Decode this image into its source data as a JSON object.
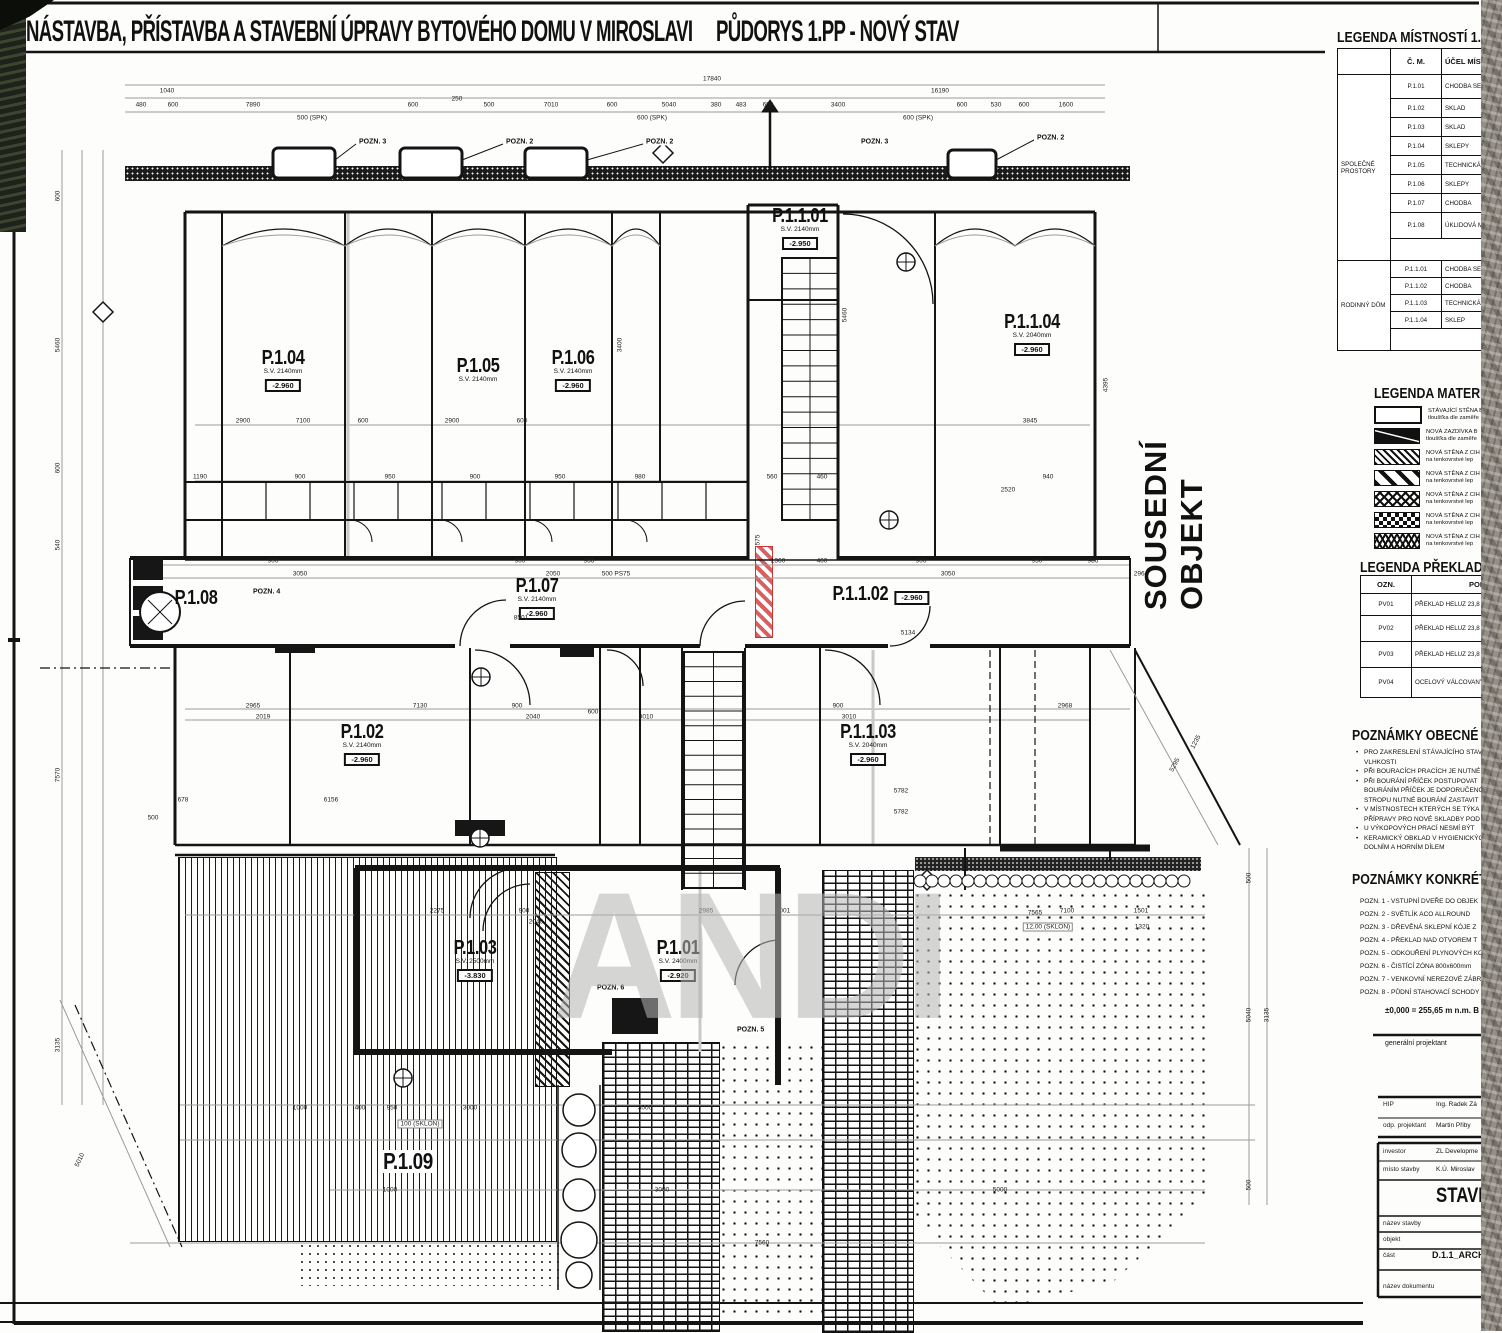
{
  "page": {
    "title_left": "NÁSTAVBA, PŘÍSTAVBA A STAVEBNÍ ÚPRAVY BYTOVÉHO DOMU V MIROSLAVI",
    "title_right": "PŮDORYS 1.PP - NOVÝ STAV"
  },
  "plan": {
    "neighbor_label": "SOUSEDNÍ OBJEKT",
    "watermark": "ANDI",
    "rooms": [
      {
        "id": "P.1.04",
        "x": 283,
        "y": 348,
        "sv": "S.V. 2140mm",
        "lvl": "-2.960"
      },
      {
        "id": "P.1.05",
        "x": 478,
        "y": 356,
        "sv": "S.V. 2140mm",
        "lvl": ""
      },
      {
        "id": "P.1.06",
        "x": 573,
        "y": 348,
        "sv": "S.V. 2140mm",
        "lvl": "-2.960"
      },
      {
        "id": "P.1.1.01",
        "x": 800,
        "y": 206,
        "sv": "S.V. 2140mm",
        "lvl": "-2.950"
      },
      {
        "id": "P.1.1.04",
        "x": 1032,
        "y": 312,
        "sv": "S.V. 2040mm",
        "lvl": "-2.960"
      },
      {
        "id": "P.1.08",
        "x": 196,
        "y": 588,
        "sv": "",
        "lvl": ""
      },
      {
        "id": "P.1.07",
        "x": 537,
        "y": 576,
        "sv": "S.V. 2140mm",
        "lvl": "-2.960"
      },
      {
        "id": "P.1.1.02",
        "x": 878,
        "y": 584,
        "sv": "",
        "lvl": "-2.960"
      },
      {
        "id": "P.1.02",
        "x": 362,
        "y": 722,
        "sv": "S.V. 2140mm",
        "lvl": "-2.960"
      },
      {
        "id": "P.1.1.03",
        "x": 868,
        "y": 722,
        "sv": "S.V. 2040mm",
        "lvl": "-2.960"
      },
      {
        "id": "P.1.03",
        "x": 475,
        "y": 938,
        "sv": "S.V. 2500mm",
        "lvl": "-3.830"
      },
      {
        "id": "P.1.01",
        "x": 678,
        "y": 938,
        "sv": "S.V. 2400mm",
        "lvl": "-2.920"
      },
      {
        "id": "P.1.09",
        "x": 408,
        "y": 1150,
        "sv": "",
        "lvl": "",
        "big": true
      }
    ],
    "markers": [
      [
        "POZN. 3",
        358,
        142
      ],
      [
        "POZN. 2",
        505,
        142
      ],
      [
        "POZN. 2",
        645,
        142
      ],
      [
        "POZN. 3",
        860,
        142
      ],
      [
        "POZN. 2",
        1036,
        138
      ],
      [
        "POZN. 4",
        252,
        592
      ],
      [
        "POZN. 6",
        596,
        988
      ],
      [
        "POZN. 5",
        736,
        1030
      ]
    ],
    "dims": [
      [
        "17840",
        712,
        79
      ],
      [
        "1040",
        167,
        91
      ],
      [
        "16190",
        940,
        91
      ],
      [
        "480",
        141,
        105
      ],
      [
        "600",
        173,
        105
      ],
      [
        "7890",
        253,
        105
      ],
      [
        "600",
        413,
        105
      ],
      [
        "250",
        457,
        99
      ],
      [
        "500",
        489,
        105
      ],
      [
        "7010",
        551,
        105
      ],
      [
        "600",
        612,
        105
      ],
      [
        "5040",
        669,
        105
      ],
      [
        "380",
        716,
        105
      ],
      [
        "483",
        741,
        105
      ],
      [
        "600",
        768,
        105
      ],
      [
        "3400",
        838,
        105
      ],
      [
        "600",
        962,
        105
      ],
      [
        "530",
        996,
        105
      ],
      [
        "600",
        1024,
        105
      ],
      [
        "1600",
        1066,
        105
      ],
      [
        "500 (SPK)",
        312,
        118
      ],
      [
        "600 (SPK)",
        652,
        118
      ],
      [
        "600 (SPK)",
        918,
        118
      ],
      [
        "600",
        58,
        196,
        -90
      ],
      [
        "5460",
        58,
        345,
        -90
      ],
      [
        "600",
        58,
        468,
        -90
      ],
      [
        "540",
        58,
        545,
        -90
      ],
      [
        "7570",
        58,
        775,
        -90
      ],
      [
        "3135",
        58,
        1045,
        -90
      ],
      [
        "5010",
        80,
        1160,
        -65
      ],
      [
        "500",
        1249,
        878,
        -90
      ],
      [
        "5040",
        1249,
        1015,
        -90
      ],
      [
        "3135",
        1267,
        1015,
        -90
      ],
      [
        "500",
        1249,
        1185,
        -90
      ],
      [
        "2900",
        243,
        421
      ],
      [
        "7100",
        303,
        421
      ],
      [
        "600",
        363,
        421
      ],
      [
        "2900",
        452,
        421
      ],
      [
        "600",
        522,
        421
      ],
      [
        "3845",
        1030,
        421
      ],
      [
        "4395",
        1106,
        385,
        -90
      ],
      [
        "5460",
        845,
        315,
        -90
      ],
      [
        "3400",
        620,
        345,
        -90
      ],
      [
        "1190",
        200,
        477
      ],
      [
        "900",
        300,
        477
      ],
      [
        "950",
        390,
        477
      ],
      [
        "900",
        475,
        477
      ],
      [
        "950",
        560,
        477
      ],
      [
        "980",
        640,
        477
      ],
      [
        "560",
        772,
        477
      ],
      [
        "460",
        822,
        477
      ],
      [
        "940",
        1048,
        477
      ],
      [
        "2520",
        1008,
        490
      ],
      [
        "900",
        273,
        561
      ],
      [
        "3050",
        300,
        574
      ],
      [
        "900",
        520,
        561
      ],
      [
        "2050",
        553,
        574
      ],
      [
        "966",
        589,
        561
      ],
      [
        "500 PS75",
        616,
        574
      ],
      [
        "1360",
        778,
        561
      ],
      [
        "460",
        822,
        561
      ],
      [
        "900",
        921,
        561
      ],
      [
        "3050",
        948,
        574
      ],
      [
        "950",
        1037,
        561
      ],
      [
        "986",
        1093,
        561
      ],
      [
        "2964",
        1141,
        574
      ],
      [
        "8501",
        521,
        618
      ],
      [
        "5134",
        908,
        633
      ],
      [
        "575",
        758,
        540,
        -90
      ],
      [
        "2965",
        253,
        706
      ],
      [
        "2019",
        263,
        717
      ],
      [
        "7130",
        420,
        706
      ],
      [
        "900",
        517,
        706
      ],
      [
        "2040",
        533,
        717
      ],
      [
        "600",
        593,
        712
      ],
      [
        "3010",
        646,
        717
      ],
      [
        "900",
        838,
        706
      ],
      [
        "3010",
        849,
        717
      ],
      [
        "2968",
        1065,
        706
      ],
      [
        "5782",
        901,
        791
      ],
      [
        "5782",
        901,
        812
      ],
      [
        "6156",
        331,
        800
      ],
      [
        "678",
        183,
        800
      ],
      [
        "500",
        153,
        818
      ],
      [
        "2275",
        437,
        911
      ],
      [
        "900",
        524,
        911
      ],
      [
        "2040",
        536,
        922
      ],
      [
        "2985",
        706,
        911
      ],
      [
        "1001",
        783,
        911
      ],
      [
        "7100",
        1067,
        911
      ],
      [
        "1501",
        1141,
        911
      ],
      [
        "7565",
        1035,
        913
      ],
      [
        "12,00 (SKLON)",
        1048,
        927,
        0,
        1
      ],
      [
        "1320",
        1142,
        927
      ],
      [
        "1000",
        300,
        1108
      ],
      [
        "400",
        360,
        1108
      ],
      [
        "950",
        392,
        1108
      ],
      [
        "3000",
        470,
        1108
      ],
      [
        "100 (SKLON)",
        420,
        1124,
        0,
        1
      ],
      [
        "3000",
        645,
        1108
      ],
      [
        "1000",
        390,
        1190
      ],
      [
        "3000",
        662,
        1190
      ],
      [
        "5000",
        1000,
        1190
      ],
      [
        "7560",
        762,
        1243
      ],
      [
        "1235",
        1196,
        742,
        -62
      ],
      [
        "5295",
        1175,
        765,
        -62
      ]
    ]
  },
  "sidebar": {
    "legend_rooms": {
      "title": "LEGENDA MÍSTNOSTÍ 1.PP",
      "col_cm": "Č. M.",
      "col_purpose": "ÚČEL MÍSTNOSTI",
      "groups": [
        {
          "name": "SPOLEČNÉ PROSTORY",
          "rows": [
            [
              "P.1.01",
              "CHODBA SE SCHODIŠTĚM"
            ],
            [
              "P.1.02",
              "SKLAD"
            ],
            [
              "P.1.03",
              "SKLAD"
            ],
            [
              "P.1.04",
              "SKLEPY"
            ],
            [
              "P.1.05",
              "TECHNICKÁ MÍSTNOST"
            ],
            [
              "P.1.06",
              "SKLEPY"
            ],
            [
              "P.1.07",
              "CHODBA"
            ],
            [
              "P.1.08",
              "ÚKLIDOVÁ MÍSTNOST"
            ]
          ],
          "footer": "CELKOVÁ PLOCHA"
        },
        {
          "name": "RODINNÝ DŮM",
          "rows": [
            [
              "P.1.1.01",
              "CHODBA SE SCHODIŠTĚM"
            ],
            [
              "P.1.1.02",
              "CHODBA"
            ],
            [
              "P.1.1.03",
              "TECHNICKÁ MÍSTNOST"
            ],
            [
              "P.1.1.04",
              "SKLEP"
            ]
          ],
          "footer": "CELKOVÁ PLOCHA"
        }
      ]
    },
    "legend_materials": {
      "title": "LEGENDA MATERIÁLŮ",
      "items": [
        {
          "pattern": "sw-existing",
          "line1": "STÁVAJÍCÍ STĚNA B",
          "line2": "tloušťka dle zaměře"
        },
        {
          "pattern": "sw-infill",
          "line1": "NOVÁ ZAZDÍVKA B",
          "line2": "tloušťka dle zaměře"
        },
        {
          "pattern": "sw-diag-dense",
          "line1": "NOVÁ STĚNA Z CIH",
          "line2": "na tenkovrstvé lep"
        },
        {
          "pattern": "sw-diag-wide",
          "line1": "NOVÁ STĚNA Z CIH",
          "line2": "na tenkovrstvé lep"
        },
        {
          "pattern": "sw-cross1",
          "line1": "NOVÁ STĚNA Z CIH",
          "line2": "na tenkovrstvé lep"
        },
        {
          "pattern": "sw-checker",
          "line1": "NOVÁ STĚNA Z CIH",
          "line2": "na tenkovrstvé lep"
        },
        {
          "pattern": "sw-cross2",
          "line1": "NOVÁ STĚNA Z CIH",
          "line2": "na tenkovrstvé lep"
        }
      ]
    },
    "legend_lintels": {
      "title": "LEGENDA PŘEKLADŮ",
      "col_ozn": "OZN.",
      "col_popis": "POPIS",
      "rows": [
        [
          "PV01",
          "PŘEKLAD HELUZ 23,8 A - 2"
        ],
        [
          "PV02",
          "PŘEKLAD HELUZ 23,8 B - 1"
        ],
        [
          "PV03",
          "PŘEKLAD HELUZ 23,8 B - 1"
        ],
        [
          "PV04",
          "OCELOVÝ VÁLCOVANÝ I PRO FIL"
        ]
      ]
    },
    "notes_general": {
      "title": "POZNÁMKY OBECNÉ",
      "lines": [
        {
          "b": true,
          "t": "PRO ZAKRESLENÍ STÁVAJÍCÍHO STAV"
        },
        {
          "b": false,
          "t": "VLHKOSTI"
        },
        {
          "b": true,
          "t": "PŘI BOURACÍCH PRACÍCH JE NUTNÉ"
        },
        {
          "b": true,
          "t": "PŘI BOURÁNÍ PŘÍČEK POSTUPOVAT"
        },
        {
          "b": false,
          "t": "BOURÁNÍM PŘÍČEK JE DOPORUČENO"
        },
        {
          "b": false,
          "t": "STROPU NUTNÉ BOURÁNÍ ZASTAVIT"
        },
        {
          "b": true,
          "t": "V MÍSTNOSTECH KTERÝCH SE TÝKA"
        },
        {
          "b": false,
          "t": "PŘÍPRAVY PRO NOVÉ SKLADBY POD"
        },
        {
          "b": true,
          "t": "U VÝKOPOVÝCH PRACÍ NESMÍ BÝT"
        },
        {
          "b": true,
          "t": "KERAMICKÝ OBKLAD V HYGIENICKÝCH"
        },
        {
          "b": false,
          "t": "DOLNÍM A HORNÍM DÍLEM"
        }
      ]
    },
    "notes_specific": {
      "title": "POZNÁMKY KONKRÉTNÍ",
      "lines": [
        "POZN. 1 - VSTUPNÍ DVEŘE DO OBJEK",
        "POZN. 2 - SVĚTLÍK ACO ALLROUND",
        "POZN. 3 - DŘEVĚNÁ SKLEPNÍ KÓJE Z",
        "POZN. 4 - PŘEKLAD NAD OTVOREM T",
        "POZN. 5 - ODKOUŘENÍ PLYNOVÝCH KO",
        "POZN. 6 - ČISTÍCÍ ZÓNA 800x600mm",
        "POZN. 7 - VENKOVNÍ NEREZOVÉ ZÁBR",
        "POZN. 8 - PŮDNÍ STAHOVACÍ SCHODY"
      ]
    },
    "elevation_line": "±0,000 = 255,65   m n.m. B",
    "gen_projektant": "generální projektant",
    "titleblock": {
      "rows_top": [
        {
          "label": "HIP",
          "value": "Ing. Radek Zá"
        },
        {
          "label": "odp. projektant",
          "value": "Martin Přiby"
        }
      ],
      "rows_box": [
        {
          "label": "investor",
          "value": "ZL Developme"
        },
        {
          "label": "místo stavby",
          "value": "K.Ú. Miroslav"
        }
      ],
      "big": "STAVEB",
      "rows_lower": [
        {
          "label": "název stavby",
          "value": ""
        },
        {
          "label": "objekt",
          "value": ""
        },
        {
          "label": "část",
          "value": "D.1.1_ARCHIT"
        },
        {
          "label": "název dokumentu",
          "value": ""
        }
      ]
    }
  }
}
